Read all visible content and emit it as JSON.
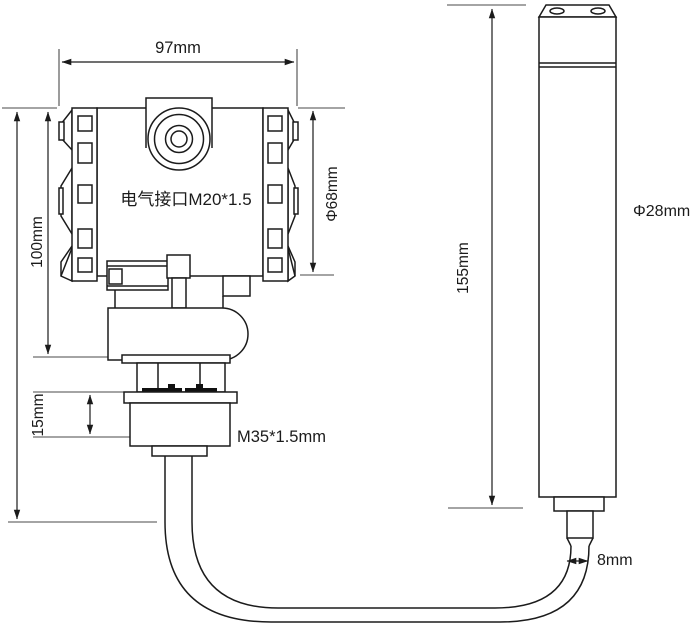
{
  "labels": {
    "head_width": "97mm",
    "electrical_interface": "电气接口M20*1.5",
    "head_diameter": "Φ68mm",
    "head_height": "100mm",
    "thread_length": "15mm",
    "thread_spec": "M35*1.5mm",
    "probe_length": "155mm",
    "probe_diameter": "Φ28mm",
    "cable_diameter": "8mm"
  },
  "colors": {
    "object_line": "#1b1b1b",
    "dimension_line": "#3c3c3c",
    "background": "#ffffff"
  }
}
